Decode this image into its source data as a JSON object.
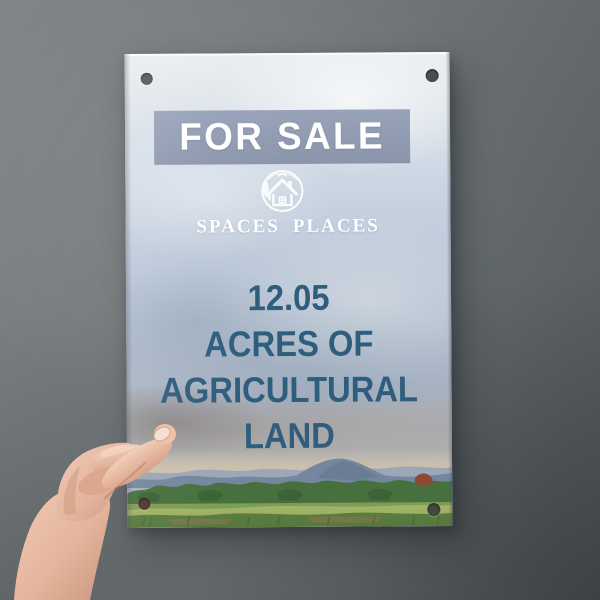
{
  "sign": {
    "banner": {
      "label": "FOR SALE"
    },
    "brand": {
      "word1": "SPACES",
      "word2": "PLACES",
      "logo_icon": "house-leaves-circle-icon"
    },
    "headline": {
      "lines": [
        "12.05",
        "ACRES OF",
        "AGRICULTURAL",
        "LAND"
      ]
    }
  },
  "colors": {
    "wall_top_left": "#818588",
    "wall_bottom_right": "#565c5e",
    "banner_bg": "#8a95ad",
    "banner_text": "#ffffff",
    "brand_text": "#ffffff",
    "headline_text": "#2f5d7d",
    "sky_top": "#eaedf0",
    "sky_mid": "#b0bed0",
    "cloud_taupe": "#a69b93",
    "horizon_warm": "#d2c4ab",
    "mountain": "#75879f",
    "treeline": "#47703f",
    "field_green": "#86a455",
    "skin_tone": "#e8bda6"
  }
}
